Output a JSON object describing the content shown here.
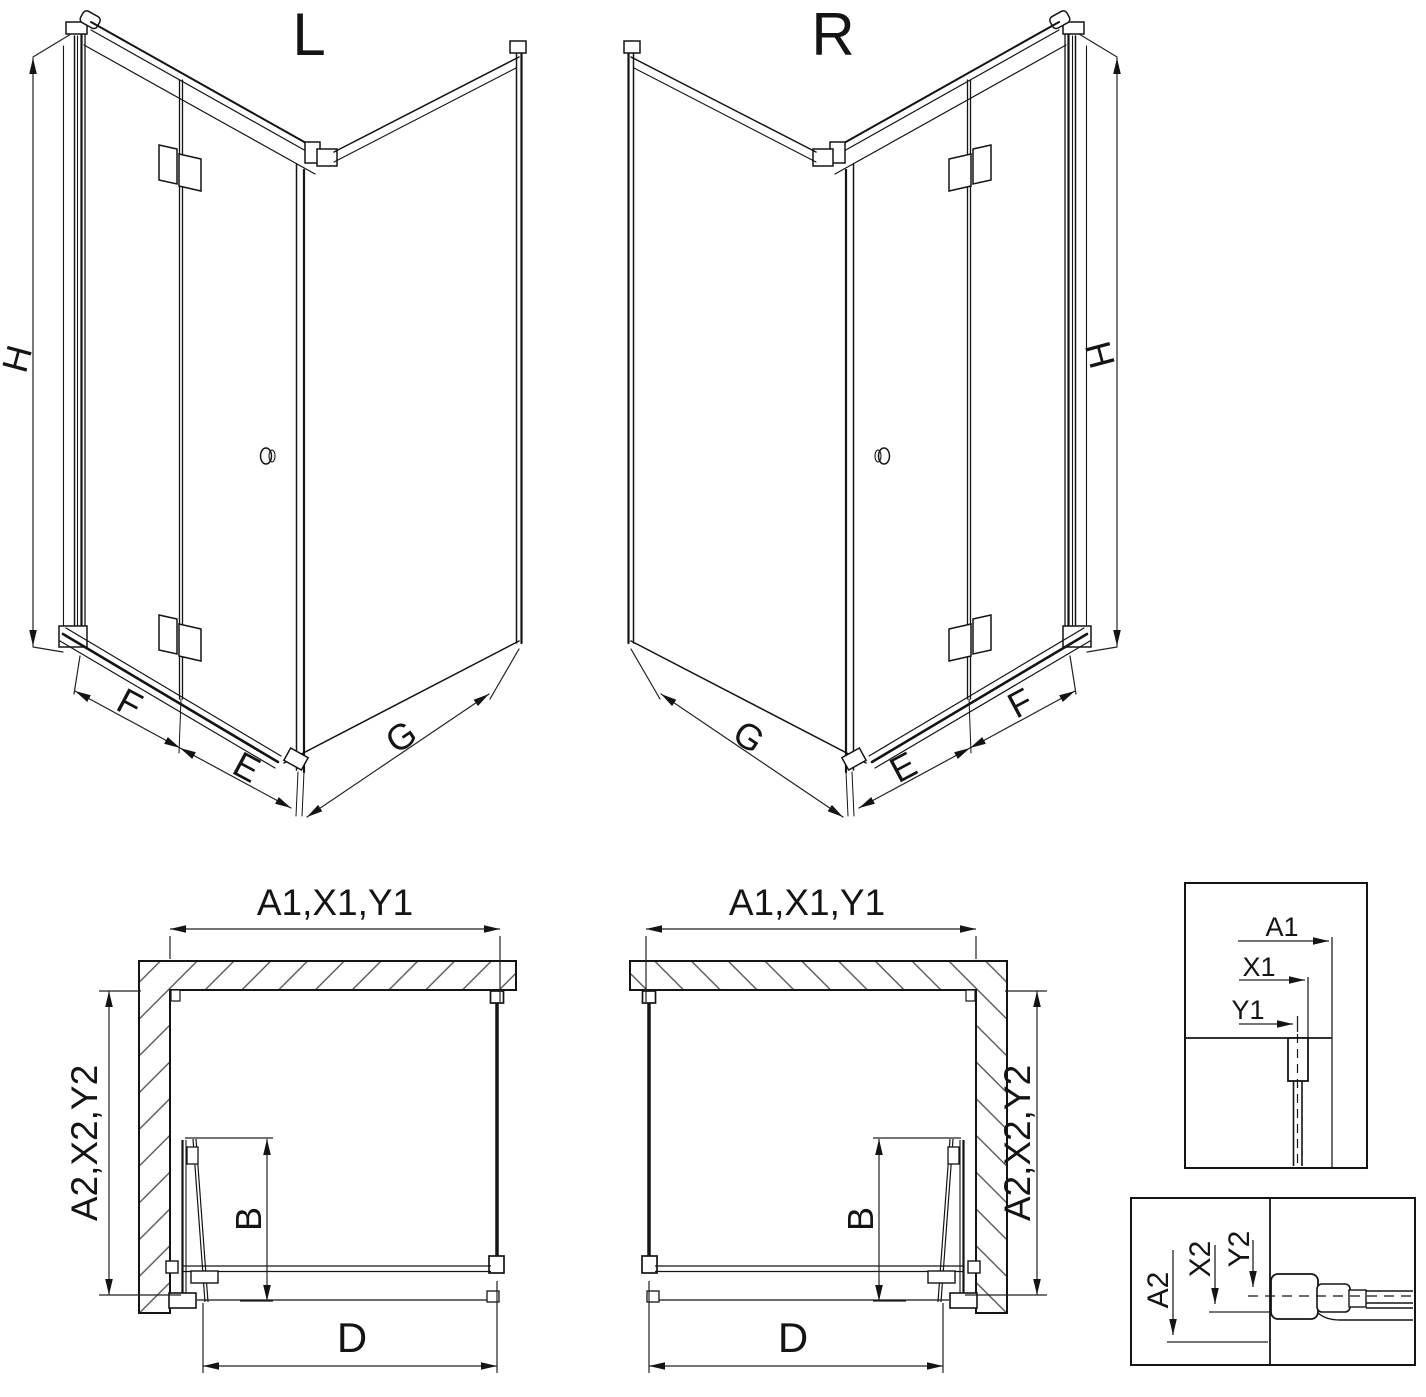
{
  "sheet": {
    "background": "#ffffff",
    "ink": "#141414"
  },
  "views": {
    "iso_left": {
      "title": "L",
      "dim_height": "H",
      "dim_door_section": "F",
      "dim_door_leaf": "E",
      "dim_side_panel": "G"
    },
    "iso_right": {
      "title": "R",
      "dim_height": "H",
      "dim_door_section": "F",
      "dim_door_leaf": "E",
      "dim_side_panel": "G"
    },
    "plan_left": {
      "dim_width": "A1,X1,Y1",
      "dim_depth": "A2,X2,Y2",
      "dim_fold_depth": "B",
      "dim_entry_width": "D"
    },
    "plan_right": {
      "dim_width": "A1,X1,Y1",
      "dim_depth": "A2,X2,Y2",
      "dim_fold_depth": "B",
      "dim_entry_width": "D"
    },
    "detail_top": {
      "dim_a1": "A1",
      "dim_x1": "X1",
      "dim_y1": "Y1"
    },
    "detail_bottom": {
      "dim_a2": "A2",
      "dim_x2": "X2",
      "dim_y2": "Y2"
    }
  }
}
